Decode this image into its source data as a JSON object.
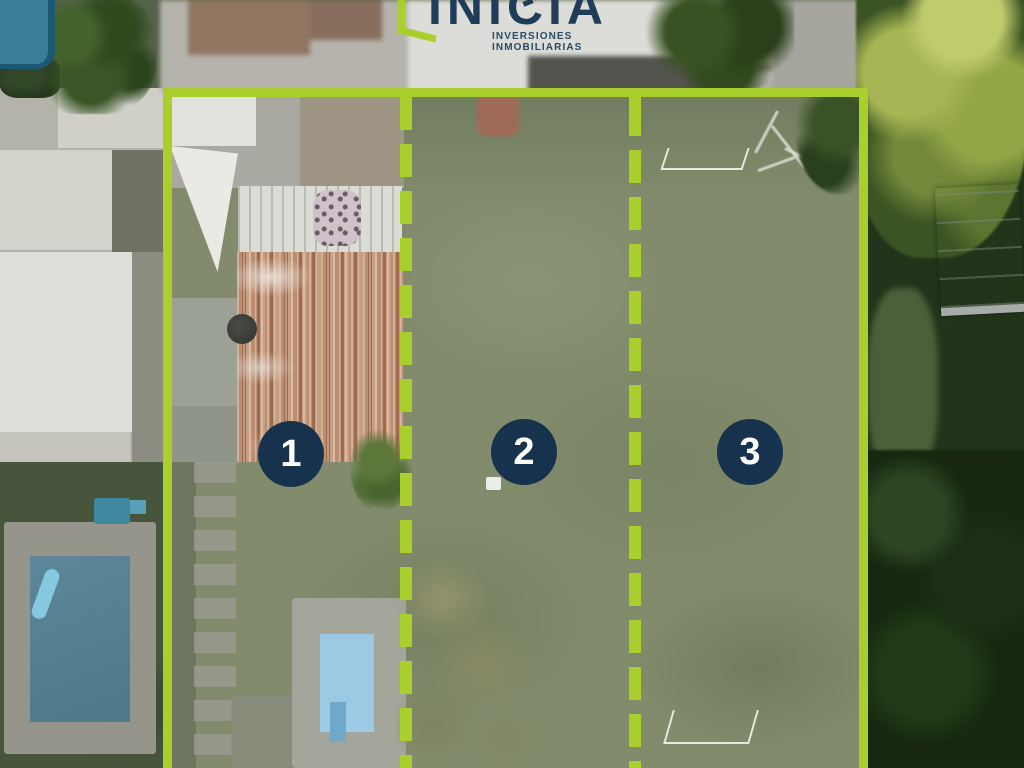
{
  "brand": {
    "name": "INICIA",
    "tagline": "INVERSIONES INMOBILIARIAS"
  },
  "lots": [
    {
      "number": "1"
    },
    {
      "number": "2"
    },
    {
      "number": "3"
    }
  ],
  "colors": {
    "accent": "#A9CF2C",
    "badge_navy": "#17324C",
    "brand_navy": "#1F3D59"
  }
}
